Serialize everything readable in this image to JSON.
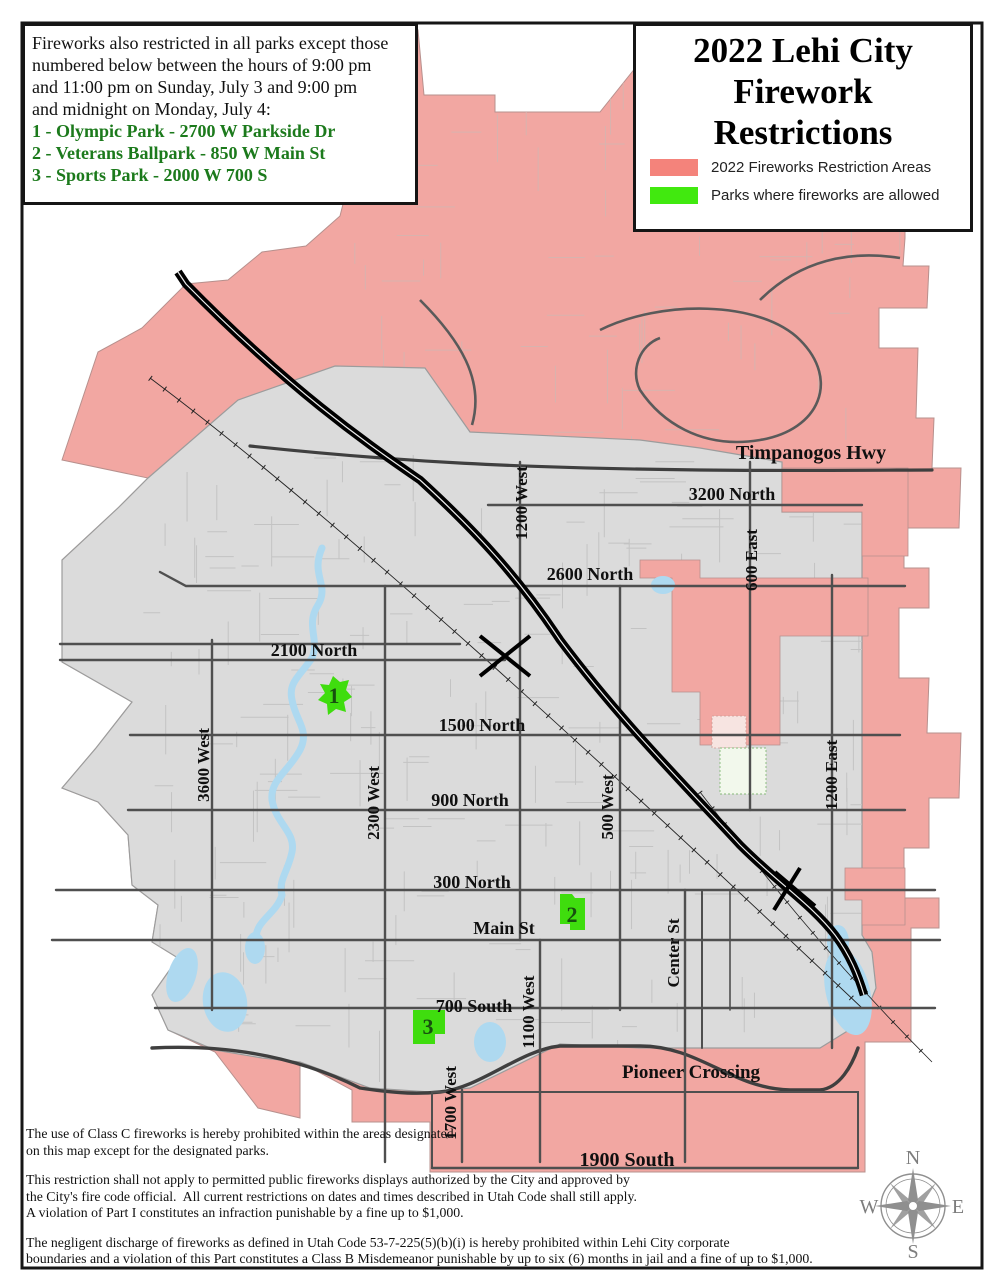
{
  "info_box": {
    "intro_lines": [
      "Fireworks also restricted in all parks except those",
      "numbered below between the hours of 9:00 pm",
      "and 11:00 pm on Sunday, July 3 and 9:00 pm",
      "and midnight on Monday, July 4:"
    ],
    "park_lines": [
      "1 - Olympic Park - 2700 W Parkside Dr",
      "2 - Veterans Ballpark - 850 W Main St",
      "3 - Sports Park - 2000 W 700 S"
    ]
  },
  "title_box": {
    "title_lines": [
      "2022 Lehi City",
      "Firework",
      "Restrictions"
    ],
    "legend": [
      {
        "label": "2022 Fireworks Restriction Areas",
        "color": "#F4837B"
      },
      {
        "label": "Parks where fireworks are allowed",
        "color": "#41E90F"
      }
    ]
  },
  "map": {
    "colors": {
      "restriction_fill": "#F2A7A2",
      "park_fill": "#3FDD0E",
      "city_fill": "#DBDBDB",
      "water": "#AED9F0",
      "road": "#4F4F4F",
      "freeway": "#000000"
    },
    "labels": {
      "timpanogos": "Timpanogos Hwy",
      "n3200": "3200 North",
      "n2600": "2600 North",
      "n2100": "2100 North",
      "n1500": "1500 North",
      "n900": "900 North",
      "n300": "300 North",
      "main": "Main St",
      "s700": "700 South",
      "pioneer": "Pioneer Crossing",
      "s1900": "1900 South",
      "w1200": "1200 West",
      "e600": "600 East",
      "w3600": "3600 West",
      "w2300": "2300 West",
      "w500": "500 West",
      "e1200": "1200 East",
      "center_st": "Center St",
      "w1100": "1100 West",
      "w1700": "1700 West"
    },
    "park_markers": [
      {
        "number": "1"
      },
      {
        "number": "2"
      },
      {
        "number": "3"
      }
    ]
  },
  "footnotes": [
    {
      "lines": [
        "The use of Class C fireworks is hereby prohibited within the areas designated",
        "on this map except for the designated parks."
      ]
    },
    {
      "lines": [
        "This restriction shall not apply to permitted public fireworks displays authorized by the City and approved by",
        "the City's fire code official.  All current restrictions on dates and times described in Utah Code shall still apply.",
        "A violation of Part I constitutes an infraction punishable by a fine up to $1,000."
      ]
    },
    {
      "lines": [
        "The negligent discharge of fireworks as defined in Utah Code 53-7-225(5)(b)(i) is hereby prohibited within Lehi City corporate",
        "boundaries and a violation of this Part constitutes a Class B Misdemeanor punishable by up to six (6) months in jail and a fine of up to $1,000."
      ]
    }
  ],
  "compass": {
    "n": "N",
    "e": "E",
    "s": "S",
    "w": "W"
  }
}
